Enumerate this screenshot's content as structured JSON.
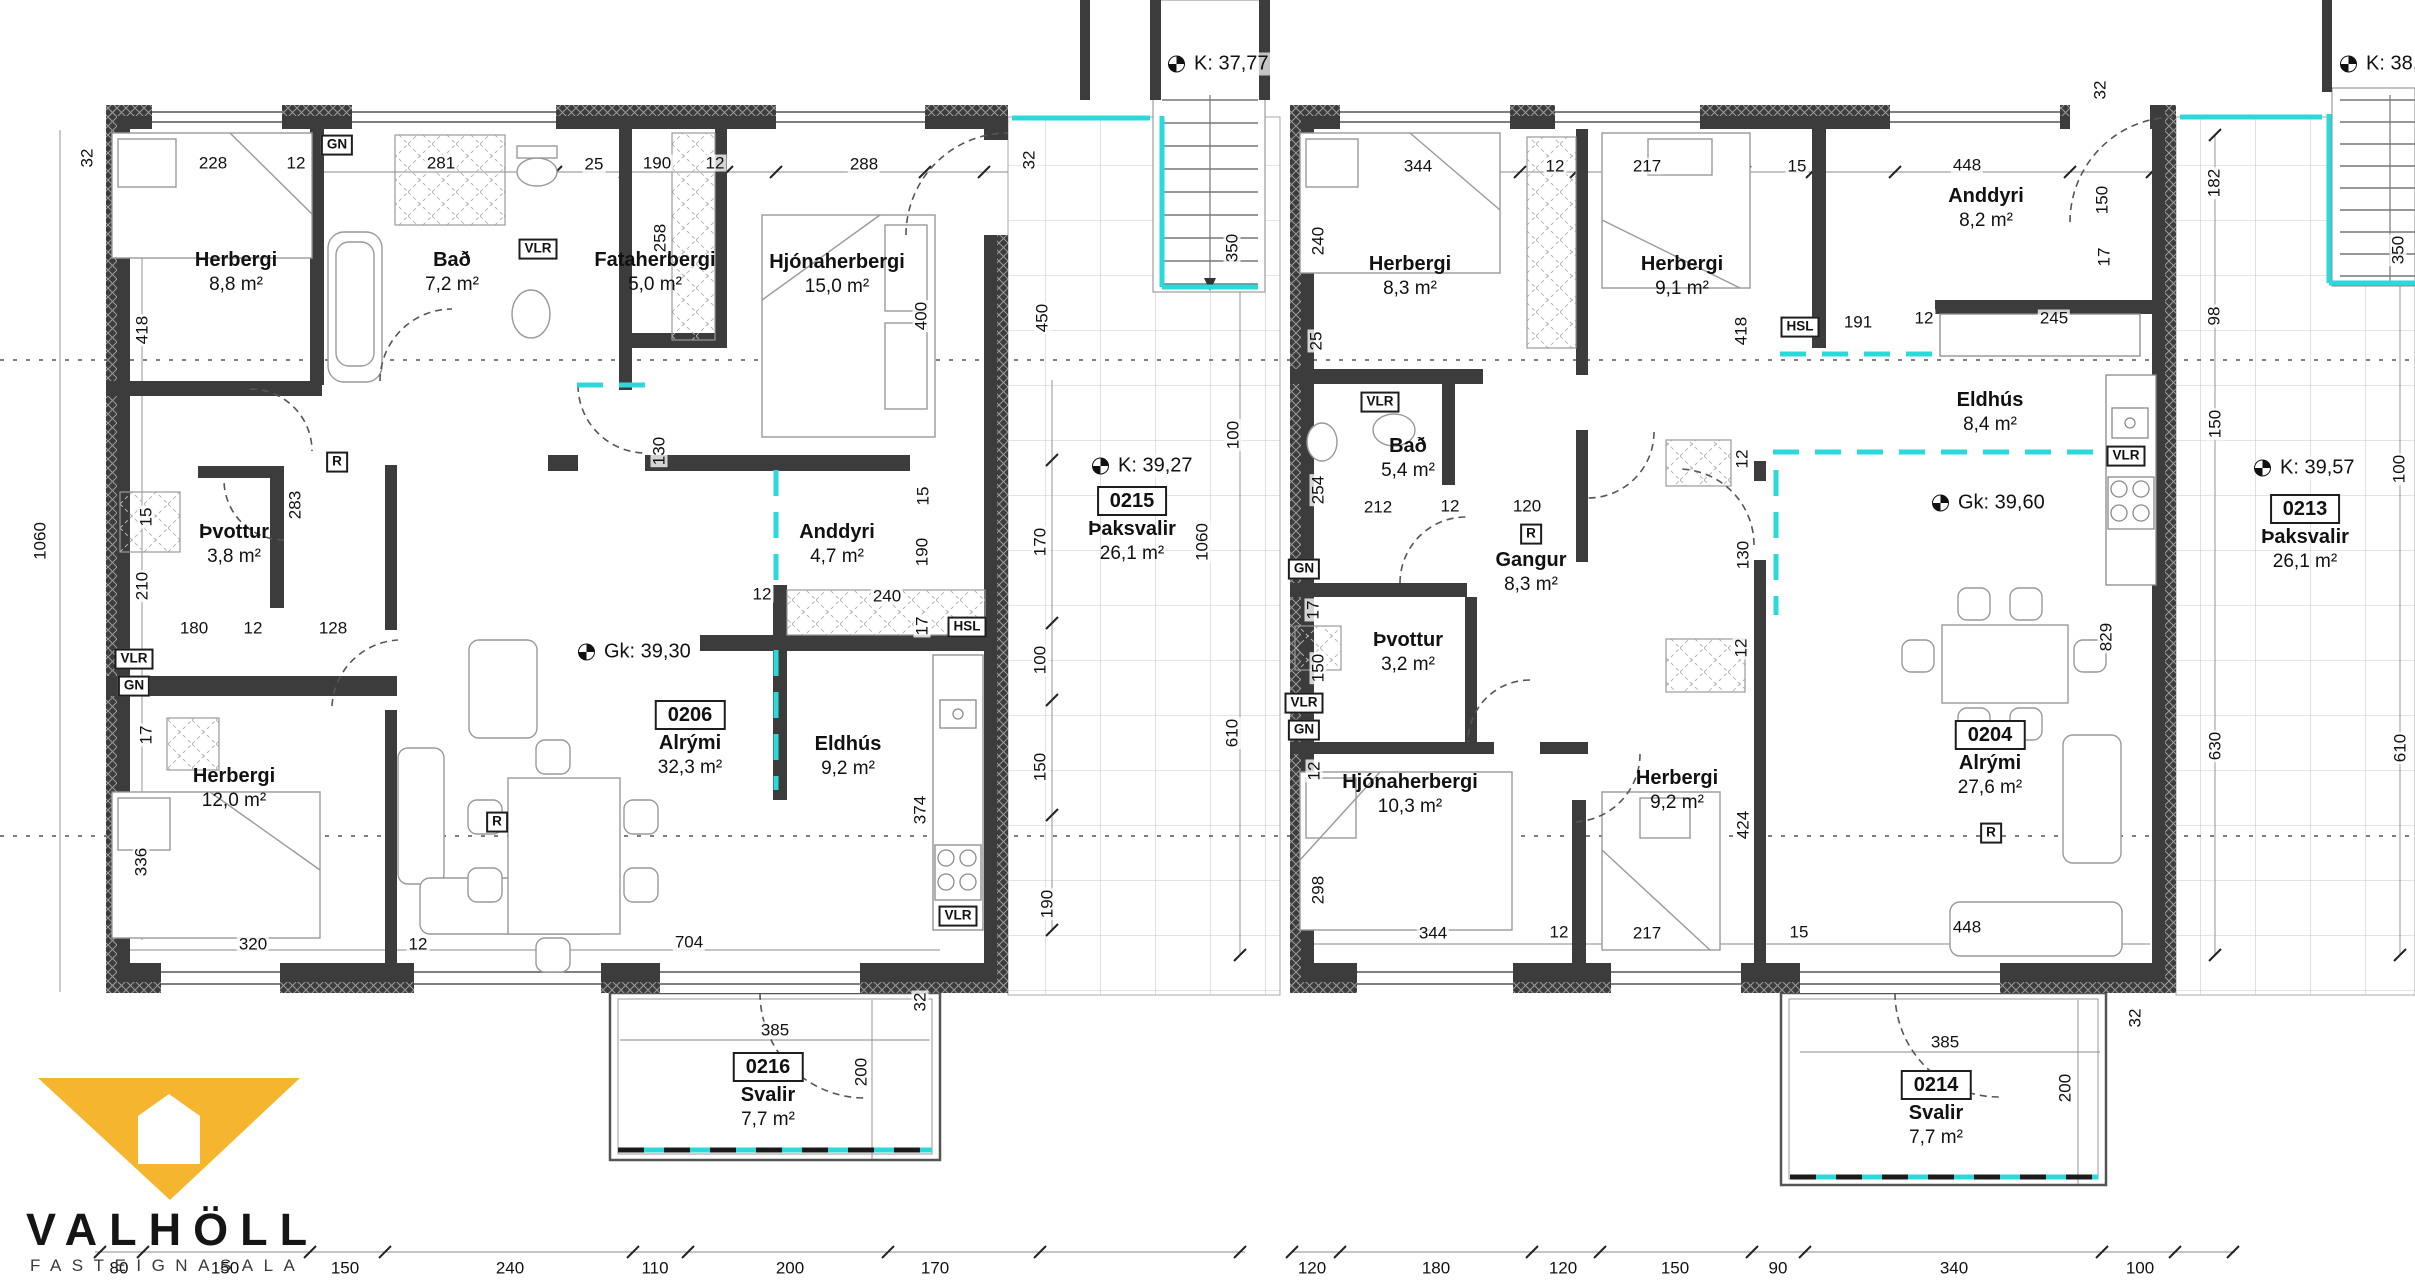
{
  "branding": {
    "name": "VALHÖLL",
    "subtitle": "FASTEIGNASALA"
  },
  "colors": {
    "wall": "#3c3c3c",
    "terrace_cyan": "#2bd9db",
    "logo_yellow": "#f6b52e",
    "grid": "#c8c8c8"
  },
  "rooms": [
    {
      "name": "Herbergi",
      "area": "8,8 m²",
      "x": 236,
      "y": 272
    },
    {
      "name": "Bað",
      "area": "7,2 m²",
      "x": 452,
      "y": 272
    },
    {
      "name": "Fataherbergi",
      "area": "5,0 m²",
      "x": 655,
      "y": 272
    },
    {
      "name": "Hjónaherbergi",
      "area": "15,0 m²",
      "x": 837,
      "y": 274
    },
    {
      "name": "Þvottur",
      "area": "3,8 m²",
      "x": 234,
      "y": 544
    },
    {
      "name": "Anddyri",
      "area": "4,7 m²",
      "x": 837,
      "y": 544
    },
    {
      "name": "Herbergi",
      "area": "12,0 m²",
      "x": 234,
      "y": 788
    },
    {
      "name": "Eldhús",
      "area": "9,2 m²",
      "x": 848,
      "y": 756
    },
    {
      "name": "Herbergi",
      "area": "8,3 m²",
      "x": 1410,
      "y": 276
    },
    {
      "name": "Herbergi",
      "area": "9,1 m²",
      "x": 1682,
      "y": 276
    },
    {
      "name": "Anddyri",
      "area": "8,2 m²",
      "x": 1986,
      "y": 208
    },
    {
      "name": "Bað",
      "area": "5,4 m²",
      "x": 1408,
      "y": 458
    },
    {
      "name": "Gangur",
      "area": "8,3 m²",
      "x": 1531,
      "y": 572
    },
    {
      "name": "Þvottur",
      "area": "3,2 m²",
      "x": 1408,
      "y": 652
    },
    {
      "name": "Hjónaherbergi",
      "area": "10,3 m²",
      "x": 1410,
      "y": 794
    },
    {
      "name": "Herbergi",
      "area": "9,2 m²",
      "x": 1677,
      "y": 790
    },
    {
      "name": "Eldhús",
      "area": "8,4 m²",
      "x": 1990,
      "y": 412
    }
  ],
  "units": [
    {
      "id": "0206",
      "name": "Alrými",
      "area": "32,3 m²",
      "x": 690,
      "y": 714
    },
    {
      "id": "0215",
      "name": "Þaksvalir",
      "area": "26,1 m²",
      "x": 1132,
      "y": 500
    },
    {
      "id": "0216",
      "name": "Svalir",
      "area": "7,7 m²",
      "x": 768,
      "y": 1066
    },
    {
      "id": "0204",
      "name": "Alrými",
      "area": "27,6 m²",
      "x": 1990,
      "y": 734
    },
    {
      "id": "0213",
      "name": "Þaksvalir",
      "area": "26,1 m²",
      "x": 2305,
      "y": 508
    },
    {
      "id": "0214",
      "name": "Svalir",
      "area": "7,7 m²",
      "x": 1936,
      "y": 1084
    }
  ],
  "levels": [
    {
      "text": "K: 37,77",
      "x": 1168,
      "y": 64
    },
    {
      "text": "K: 38,07",
      "x": 2340,
      "y": 64
    },
    {
      "text": "K: 39,27",
      "x": 1092,
      "y": 466
    },
    {
      "text": "Gk: 39,30",
      "x": 578,
      "y": 652
    },
    {
      "text": "K: 39,57",
      "x": 2254,
      "y": 468
    },
    {
      "text": "Gk: 39,60",
      "x": 1932,
      "y": 503
    }
  ],
  "tags": [
    {
      "text": "GN",
      "x": 337,
      "y": 145
    },
    {
      "text": "VLR",
      "x": 538,
      "y": 249
    },
    {
      "text": "R",
      "x": 337,
      "y": 462
    },
    {
      "text": "VLR",
      "x": 134,
      "y": 659
    },
    {
      "text": "GN",
      "x": 134,
      "y": 686
    },
    {
      "text": "HSL",
      "x": 967,
      "y": 627
    },
    {
      "text": "VLR",
      "x": 958,
      "y": 916
    },
    {
      "text": "R",
      "x": 497,
      "y": 822
    },
    {
      "text": "GN",
      "x": 1304,
      "y": 569
    },
    {
      "text": "VLR",
      "x": 1304,
      "y": 703
    },
    {
      "text": "GN",
      "x": 1304,
      "y": 730
    },
    {
      "text": "VLR",
      "x": 1380,
      "y": 402
    },
    {
      "text": "HSL",
      "x": 1800,
      "y": 327
    },
    {
      "text": "VLR",
      "x": 2126,
      "y": 456
    },
    {
      "text": "R",
      "x": 1531,
      "y": 534
    },
    {
      "text": "R",
      "x": 1991,
      "y": 833
    }
  ],
  "dims": [
    [
      "32",
      87,
      158,
      1
    ],
    [
      "228",
      213,
      163,
      0
    ],
    [
      "12",
      296,
      163,
      0
    ],
    [
      "281",
      441,
      163,
      0
    ],
    [
      "25",
      594,
      164,
      0
    ],
    [
      "190",
      657,
      163,
      0
    ],
    [
      "12",
      715,
      163,
      0
    ],
    [
      "288",
      864,
      164,
      0
    ],
    [
      "32",
      1029,
      160,
      1
    ],
    [
      "418",
      142,
      330,
      1
    ],
    [
      "1060",
      40,
      541,
      1
    ],
    [
      "15",
      146,
      517,
      1
    ],
    [
      "210",
      142,
      586,
      1
    ],
    [
      "17",
      146,
      735,
      1
    ],
    [
      "336",
      141,
      862,
      1
    ],
    [
      "283",
      295,
      505,
      1
    ],
    [
      "258",
      660,
      238,
      1
    ],
    [
      "130",
      659,
      451,
      1
    ],
    [
      "400",
      921,
      316,
      1
    ],
    [
      "15",
      923,
      496,
      1
    ],
    [
      "180",
      194,
      628,
      0
    ],
    [
      "12",
      253,
      628,
      0
    ],
    [
      "128",
      333,
      628,
      0
    ],
    [
      "12",
      762,
      594,
      0
    ],
    [
      "240",
      887,
      596,
      0
    ],
    [
      "190",
      922,
      552,
      1
    ],
    [
      "17",
      922,
      626,
      1
    ],
    [
      "374",
      920,
      810,
      1
    ],
    [
      "320",
      253,
      944,
      0
    ],
    [
      "12",
      418,
      944,
      0
    ],
    [
      "704",
      689,
      942,
      0
    ],
    [
      "385",
      775,
      1030,
      0
    ],
    [
      "200",
      861,
      1072,
      1
    ],
    [
      "32",
      920,
      1002,
      1
    ],
    [
      "450",
      1042,
      318,
      1
    ],
    [
      "170",
      1040,
      542,
      1
    ],
    [
      "100",
      1040,
      660,
      1
    ],
    [
      "150",
      1040,
      767,
      1
    ],
    [
      "190",
      1047,
      904,
      1
    ],
    [
      "100",
      1233,
      435,
      1
    ],
    [
      "1060",
      1202,
      542,
      1
    ],
    [
      "610",
      1232,
      733,
      1
    ],
    [
      "350",
      1232,
      248,
      1
    ],
    [
      "344",
      1418,
      166,
      0
    ],
    [
      "12",
      1555,
      166,
      0
    ],
    [
      "217",
      1647,
      166,
      0
    ],
    [
      "15",
      1797,
      166,
      0
    ],
    [
      "448",
      1967,
      165,
      0
    ],
    [
      "32",
      2100,
      90,
      1
    ],
    [
      "150",
      2102,
      200,
      1
    ],
    [
      "17",
      2104,
      257,
      1
    ],
    [
      "240",
      1318,
      241,
      1
    ],
    [
      "25",
      1316,
      341,
      1
    ],
    [
      "254",
      1318,
      490,
      1
    ],
    [
      "150",
      1318,
      668,
      1
    ],
    [
      "12",
      1314,
      771,
      1
    ],
    [
      "298",
      1318,
      890,
      1
    ],
    [
      "17",
      1313,
      610,
      1
    ],
    [
      "212",
      1378,
      507,
      0
    ],
    [
      "12",
      1450,
      506,
      0
    ],
    [
      "120",
      1527,
      506,
      0
    ],
    [
      "418",
      1741,
      331,
      1
    ],
    [
      "12",
      1742,
      459,
      1
    ],
    [
      "130",
      1743,
      555,
      1
    ],
    [
      "12",
      1741,
      648,
      1
    ],
    [
      "424",
      1743,
      825,
      1
    ],
    [
      "829",
      2106,
      637,
      1
    ],
    [
      "191",
      1858,
      322,
      0
    ],
    [
      "12",
      1924,
      318,
      0
    ],
    [
      "245",
      2054,
      318,
      0
    ],
    [
      "182",
      2214,
      183,
      1
    ],
    [
      "98",
      2214,
      316,
      1
    ],
    [
      "150",
      2215,
      424,
      1
    ],
    [
      "100",
      2399,
      469,
      1
    ],
    [
      "350",
      2398,
      250,
      1
    ],
    [
      "630",
      2215,
      746,
      1
    ],
    [
      "610",
      2400,
      748,
      1
    ],
    [
      "344",
      1433,
      933,
      0
    ],
    [
      "12",
      1559,
      932,
      0
    ],
    [
      "217",
      1647,
      933,
      0
    ],
    [
      "15",
      1799,
      932,
      0
    ],
    [
      "448",
      1967,
      927,
      0
    ],
    [
      "385",
      1945,
      1042,
      0
    ],
    [
      "200",
      2065,
      1088,
      1
    ],
    [
      "32",
      2135,
      1018,
      1
    ],
    [
      "80",
      119,
      1268,
      0
    ],
    [
      "150",
      225,
      1268,
      0
    ],
    [
      "150",
      345,
      1268,
      0
    ],
    [
      "240",
      510,
      1268,
      0
    ],
    [
      "110",
      655,
      1268,
      0
    ],
    [
      "200",
      790,
      1268,
      0
    ],
    [
      "170",
      935,
      1268,
      0
    ],
    [
      "120",
      1312,
      1268,
      0
    ],
    [
      "180",
      1436,
      1268,
      0
    ],
    [
      "120",
      1563,
      1268,
      0
    ],
    [
      "150",
      1675,
      1268,
      0
    ],
    [
      "90",
      1778,
      1268,
      0
    ],
    [
      "340",
      1954,
      1268,
      0
    ],
    [
      "100",
      2140,
      1268,
      0
    ]
  ]
}
